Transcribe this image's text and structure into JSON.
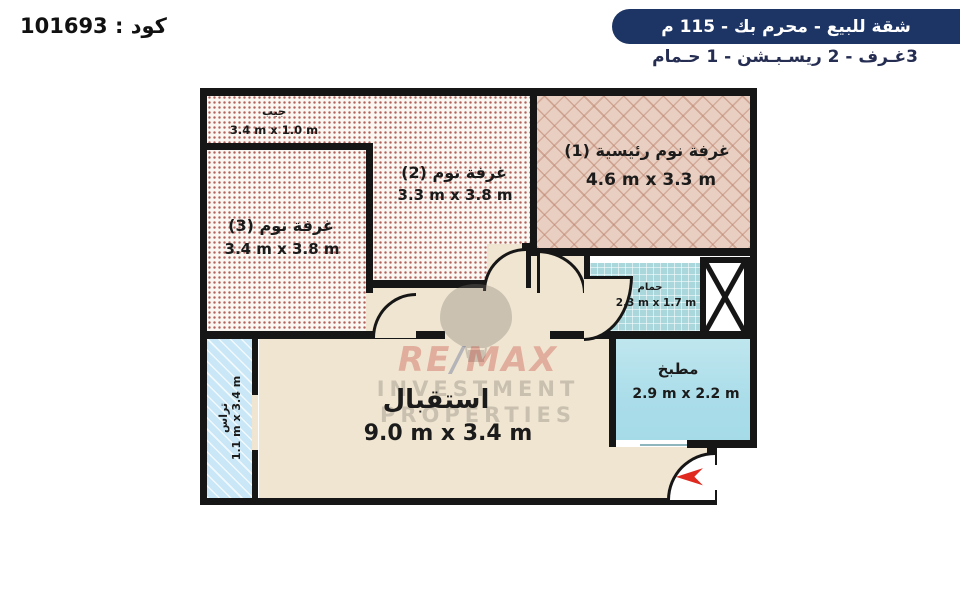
{
  "header": {
    "code": "كود : 101693",
    "title": "شقة للبيع  -  محرم بك - 115 م",
    "subtitle": "3غـرف - 2 ريسـبـشن - 1 حـمام"
  },
  "rooms": {
    "pocket": {
      "name": "جيب",
      "dims": "3.4 m x 1.0 m"
    },
    "bedroom3": {
      "name": "غرفة نوم (3)",
      "dims": "3.4 m x 3.8 m"
    },
    "bedroom2": {
      "name": "غرفة نوم (2)",
      "dims": "3.3 m x 3.8 m"
    },
    "master": {
      "name": "غرفة نوم رئيسية (1)",
      "dims": "4.6 m x 3.3 m"
    },
    "bathroom": {
      "name": "حمام",
      "dims": "2.3 m x 1.7 m"
    },
    "kitchen": {
      "name": "مطبخ",
      "dims": "2.9 m x 2.2 m"
    },
    "reception": {
      "name": "استقبال",
      "dims": "9.0 m x 3.4 m"
    },
    "terrace": {
      "name": "تراس",
      "dims": "1.1 m x 3.4 m"
    }
  },
  "watermark": {
    "brand_left": "RE",
    "brand_slash": "/",
    "brand_right": "MAX",
    "line2": "INVESTMENT",
    "line3": "PROPERTIES"
  },
  "colors": {
    "accent_navy": "#1d3565",
    "wall": "#161616",
    "entry_arrow_red": "#e02a20"
  }
}
